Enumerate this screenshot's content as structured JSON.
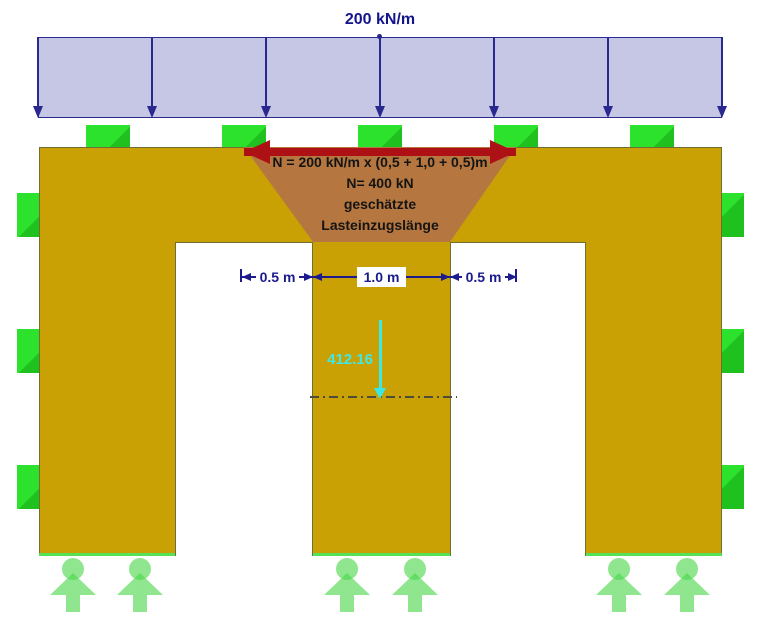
{
  "diagram": {
    "load": {
      "label": "200 kN/m",
      "band_fill": "#c6c6e5",
      "arrow_color": "#28288e"
    },
    "load_distribution": {
      "lines": [
        "N = 200 kN/m x (0,5 + 1,0 + 0,5)m",
        "N= 400 kN",
        "geschätzte",
        "Lasteinzugslänge"
      ],
      "arrow_color": "#ad1115",
      "fill_color": "#b5773f"
    },
    "dimensions": {
      "left": "0.5 m",
      "middle": "1.0 m",
      "right": "0.5 m",
      "color": "#1b1b8e"
    },
    "axial_force": {
      "value": "412.16",
      "color": "#3ae8e8"
    },
    "structure": {
      "fill_color": "#c9a105"
    },
    "supports": {
      "top_count": 5,
      "left_count": 3,
      "right_count": 3,
      "color": "#2ce22c"
    },
    "reactions": {
      "count": 6,
      "color": "#4bd64b"
    }
  }
}
